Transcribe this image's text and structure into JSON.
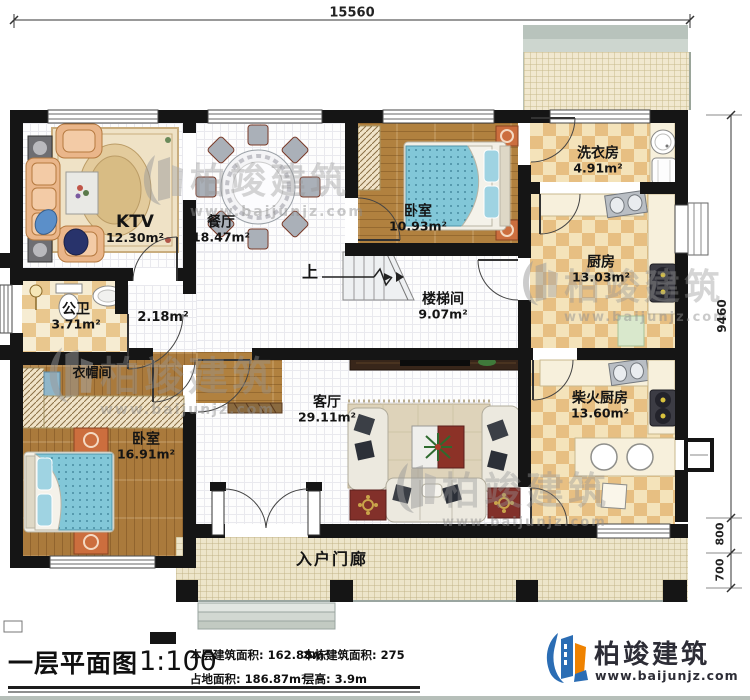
{
  "dimensions": {
    "top": "15560",
    "right": "9460",
    "right_segments": [
      "800",
      "700"
    ]
  },
  "rooms": {
    "ktv": {
      "name": "KTV",
      "area": "12.30m²"
    },
    "dining": {
      "name": "餐厅",
      "area": "18.47m²"
    },
    "bedroom2": {
      "name": "卧室",
      "area": "10.93m²"
    },
    "laundry": {
      "name": "洗衣房",
      "area": "4.91m²"
    },
    "kitchen": {
      "name": "厨房",
      "area": "13.03m²"
    },
    "stairwell": {
      "name": "楼梯间",
      "area": "9.07m²"
    },
    "bathroom": {
      "name": "公卫",
      "area": "3.71m²"
    },
    "corridor": {
      "area": "2.18m²"
    },
    "cloakroom": {
      "name": "衣帽间"
    },
    "bedroom1": {
      "name": "卧室",
      "area": "16.91m²"
    },
    "living": {
      "name": "客厅",
      "area": "29.11m²"
    },
    "firewood": {
      "name": "柴火厨房",
      "area": "13.60m²"
    },
    "porch": {
      "name": "入户门廊"
    },
    "stairs_up": "上"
  },
  "title_block": {
    "title": "一层平面图",
    "scale": "1:100",
    "floor_area_label": "本层建筑面积:",
    "floor_area": "162.88m²",
    "site_area_label": "占地面积:",
    "site_area": "186.87m²",
    "total_area_label": "本栋建筑面积:",
    "total_area": "275",
    "height_label": "层高:",
    "height": "3.9m"
  },
  "brand": {
    "name": "柏竣建筑",
    "url": "www.baijunjz.com"
  },
  "watermark": {
    "text": "柏竣建筑",
    "url": "www.baijunjz.com"
  },
  "colors": {
    "logo_blue": "#2b6db4",
    "logo_orange": "#ef8200",
    "wall": "#151515",
    "bed_blue": "#82c7d8"
  }
}
